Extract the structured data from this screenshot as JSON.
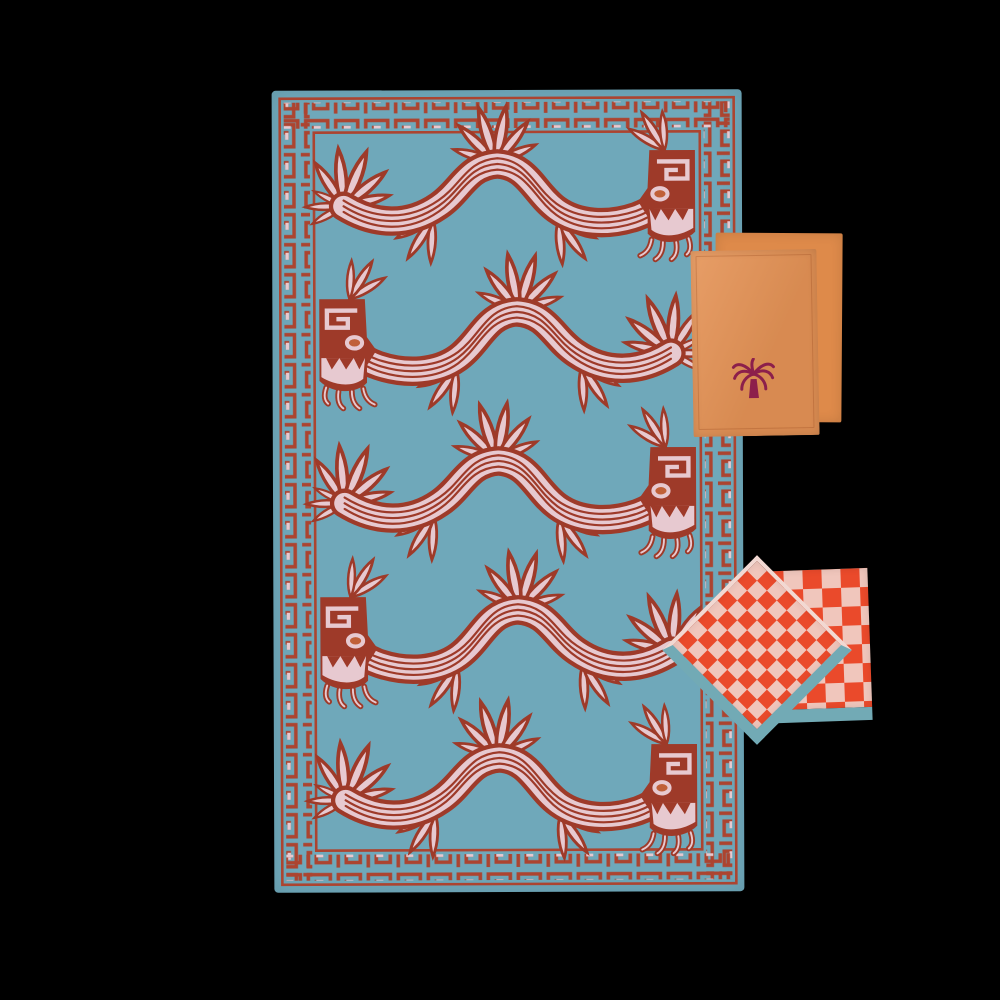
{
  "colors": {
    "background": "#000000",
    "cloth_blue": "#6FA8BA",
    "border_red": "#AC4430",
    "motif_maroon": "#9E3A29",
    "motif_pink": "#E7C9D0",
    "eye_ochre": "#C06038",
    "orange_front": "#E59356",
    "orange_back": "#DE8A4A",
    "palm_burgundy": "#8C1F4B",
    "check_red": "#EA4A2B",
    "check_pink": "#F0C6BC",
    "check_hem_blue": "#72AAB5",
    "check_edge_pale": "#F2D8D2"
  },
  "tablecloth": {
    "motif": "serpent",
    "motif_rows": 5,
    "row_directions": [
      "right",
      "left",
      "right",
      "left",
      "right"
    ],
    "border_pattern": "greek-key"
  },
  "orange_napkins": {
    "count": 2,
    "embroidery": "palm-tree"
  },
  "checkered_napkins": {
    "count": 2,
    "pattern": "checkerboard",
    "front_orientation_deg": 45
  }
}
